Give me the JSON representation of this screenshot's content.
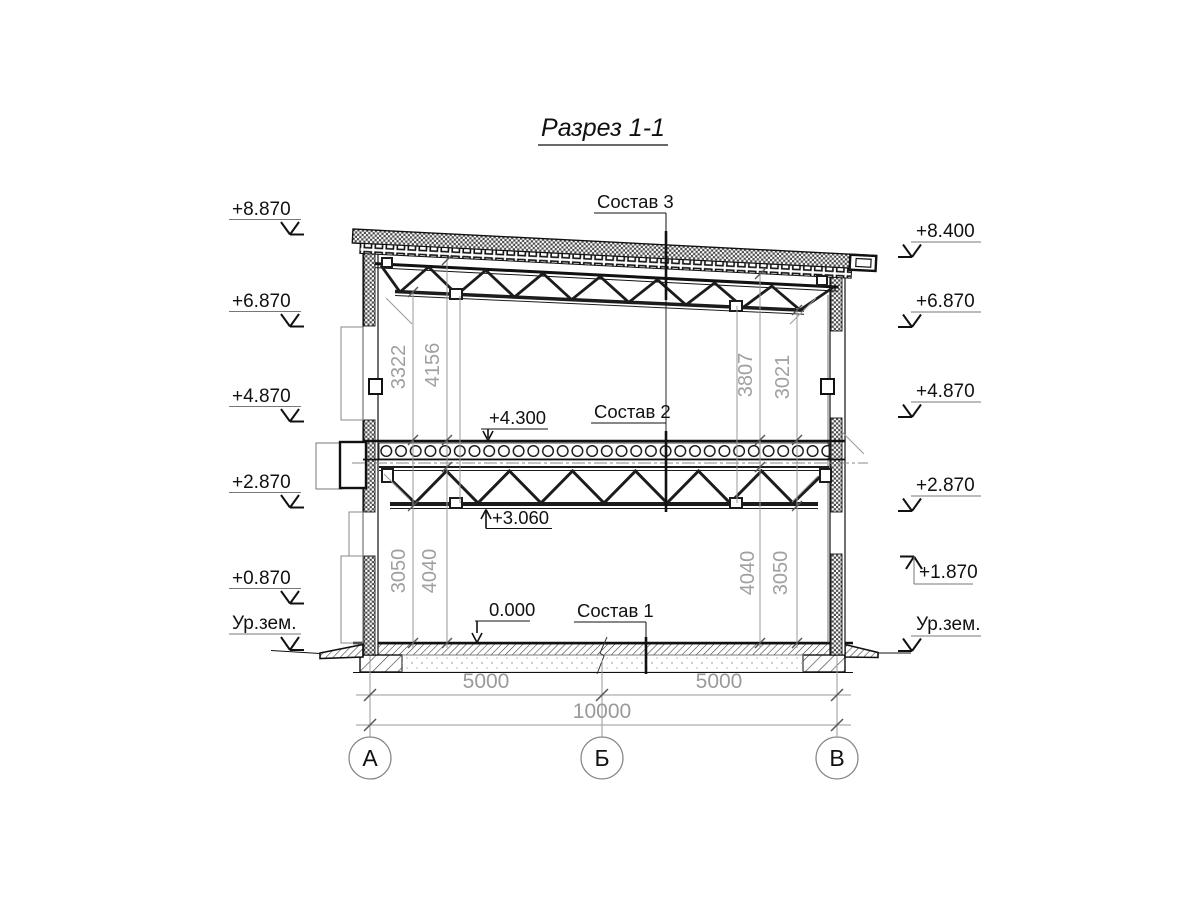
{
  "title": "Разрез 1-1",
  "annotations": {
    "sostav3": "Состав 3",
    "sostav2": "Состав 2",
    "sostav1": "Состав 1",
    "level_mid_top": "+4.300",
    "level_mid_chord": "+3.060",
    "level_zero": "0.000"
  },
  "elevations": {
    "left": [
      "+8.870",
      "+6.870",
      "+4.870",
      "+2.870",
      "+0.870",
      "Ур.зем."
    ],
    "right": [
      "+8.400",
      "+6.870",
      "+4.870",
      "+2.870",
      "+1.870",
      "Ур.зем."
    ]
  },
  "vertical_dims": {
    "left_top": [
      "3322",
      "4156"
    ],
    "right_top": [
      "3807",
      "3021"
    ],
    "left_bottom": [
      "3050",
      "4040"
    ],
    "right_bottom": [
      "4040",
      "3050"
    ]
  },
  "horizontal_dims": {
    "span_left": "5000",
    "span_right": "5000",
    "total": "10000"
  },
  "axes": [
    "А",
    "Б",
    "В"
  ],
  "colors": {
    "line": "#111111",
    "dim": "#9a9a9a"
  }
}
